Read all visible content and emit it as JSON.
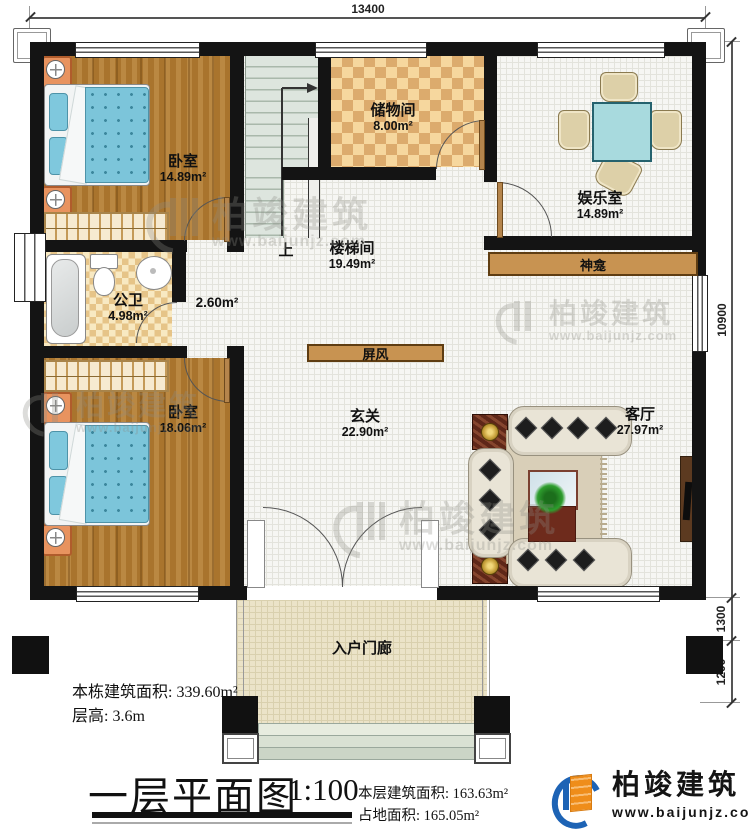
{
  "plan": {
    "dimensions": {
      "top": "13400",
      "right_total": "10900",
      "right_upper": "1300",
      "right_lower": "1200"
    },
    "rooms": {
      "bedroom1": {
        "label": "卧室",
        "area": "14.89m²"
      },
      "storage": {
        "label": "储物间",
        "area": "8.00m²"
      },
      "entertainment": {
        "label": "娱乐室",
        "area": "14.89m²"
      },
      "stairwell": {
        "label": "楼梯间",
        "area": "19.49m²"
      },
      "corridor": {
        "area": "2.60m²"
      },
      "bathroom": {
        "label": "公卫",
        "area": "4.98m²"
      },
      "bedroom2": {
        "label": "卧室",
        "area": "18.06m²"
      },
      "foyer": {
        "label": "玄关",
        "area": "22.90m²"
      },
      "living": {
        "label": "客厅",
        "area": "27.97m²"
      },
      "porch": {
        "label": "入户门廊"
      }
    },
    "fixtures": {
      "shrine": "神龛",
      "screen": "屏风",
      "stair_up": "上"
    }
  },
  "info": {
    "line1": "本栋建筑面积: 339.60m²",
    "line2": "层高: 3.6m"
  },
  "title_block": {
    "title": "一层平面图",
    "scale": "1:100",
    "floor_area": "本层建筑面积: 163.63m²",
    "site_area": "占地面积: 165.05m²"
  },
  "brand": {
    "name": "柏竣建筑",
    "site": "www.baijunjz.com"
  },
  "watermark": {
    "name": "柏竣建筑",
    "site": "www.baijunjz.com"
  },
  "colors": {
    "wall": "#141414",
    "wood": "#a9742d",
    "shrine_bar": "#c89351",
    "logo_blue": "#1d63b5",
    "logo_orange": "#ef8d1a"
  }
}
